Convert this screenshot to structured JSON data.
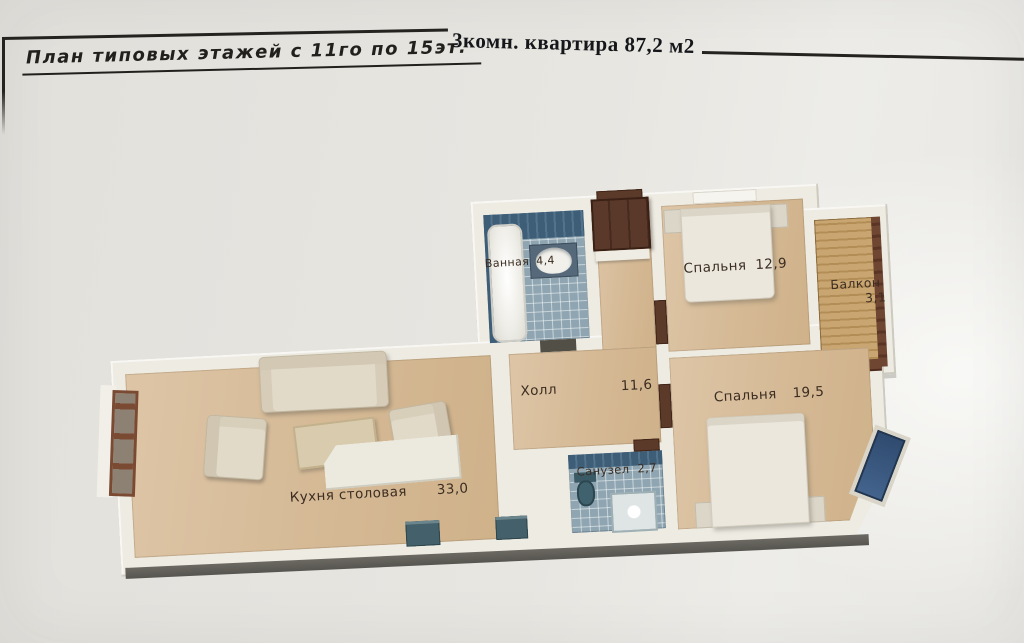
{
  "titles": {
    "sheet": "План типовых этажей с 11го по 15эт.",
    "main": "3комн. квартира  87,2 м2"
  },
  "plan": {
    "bathroom": {
      "name": "Ванная",
      "area": "4,4"
    },
    "bedroom1": {
      "name": "Спальня",
      "area": "12,9"
    },
    "balcony": {
      "name": "Балкон",
      "area": "3,1"
    },
    "hall": {
      "name": "Холл",
      "area": "11,6"
    },
    "bedroom2": {
      "name": "Спальня",
      "area": "19,5"
    },
    "kitchen": {
      "name": "Кухня столовая",
      "area": "33,0"
    },
    "wc": {
      "name": "Санузел",
      "area": "2,7"
    }
  },
  "colors": {
    "paper": "#e8e6e1",
    "wall": "#edebe2",
    "floor_tan": "#d5b995",
    "tile_blue": "#8fa6b2",
    "tile_wall_blue": "#3e5d77",
    "door_wood": "#5b3a2a",
    "label_ink": "#3b2d22",
    "window_blue": "#33517a",
    "frame_ink": "#24231f"
  }
}
